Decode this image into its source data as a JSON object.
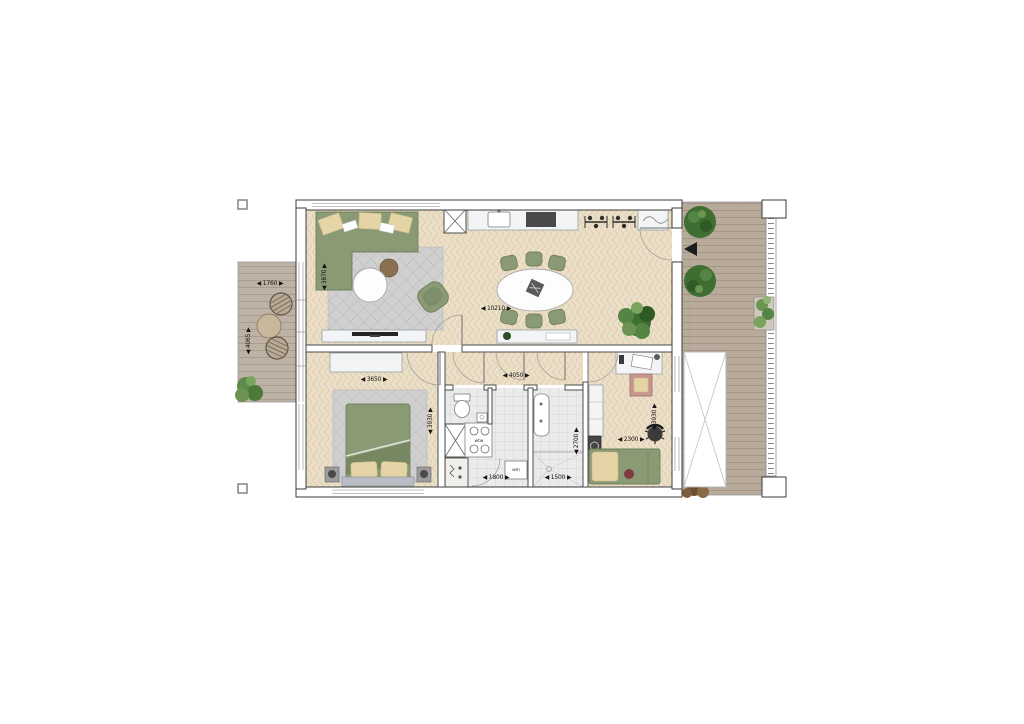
{
  "plan": {
    "type": "apartment-floor-plan",
    "dims": {
      "balcony_width": "◀ 1760 ▶",
      "balcony_depth": "◀ 4065 ▶",
      "living_depth": "◀ 3870 ▶",
      "living_length": "◀ 10210 ▶",
      "bedroom1_width": "◀ 3650 ▶",
      "bedroom1_depth": "◀ 3930 ▶",
      "hall_width": "◀ 4050 ▶",
      "laundry_width": "◀ 1800 ▶",
      "bathroom_width": "◀ 1500 ▶",
      "bathroom_depth": "◀ 2700 ▶",
      "bedroom2_width": "◀ 2300 ▶",
      "bedroom2_depth": "◀ 3930 ▶"
    },
    "labels": {
      "heat_recovery_unit": "wtw",
      "washing_machine": "wm"
    },
    "colors": {
      "parquet_floor": "#ecdfc8",
      "deck_wood": "#b9ab9c",
      "wall_line": "#3b3b3b",
      "sofa_green": "#8a9a74",
      "cushion_beige": "#e4d4a6",
      "tile_gray": "#ebebeb",
      "rug_gray": "#d0d0d0",
      "plant_green": "#4c7a38",
      "accent_red": "#7e3b44"
    }
  }
}
